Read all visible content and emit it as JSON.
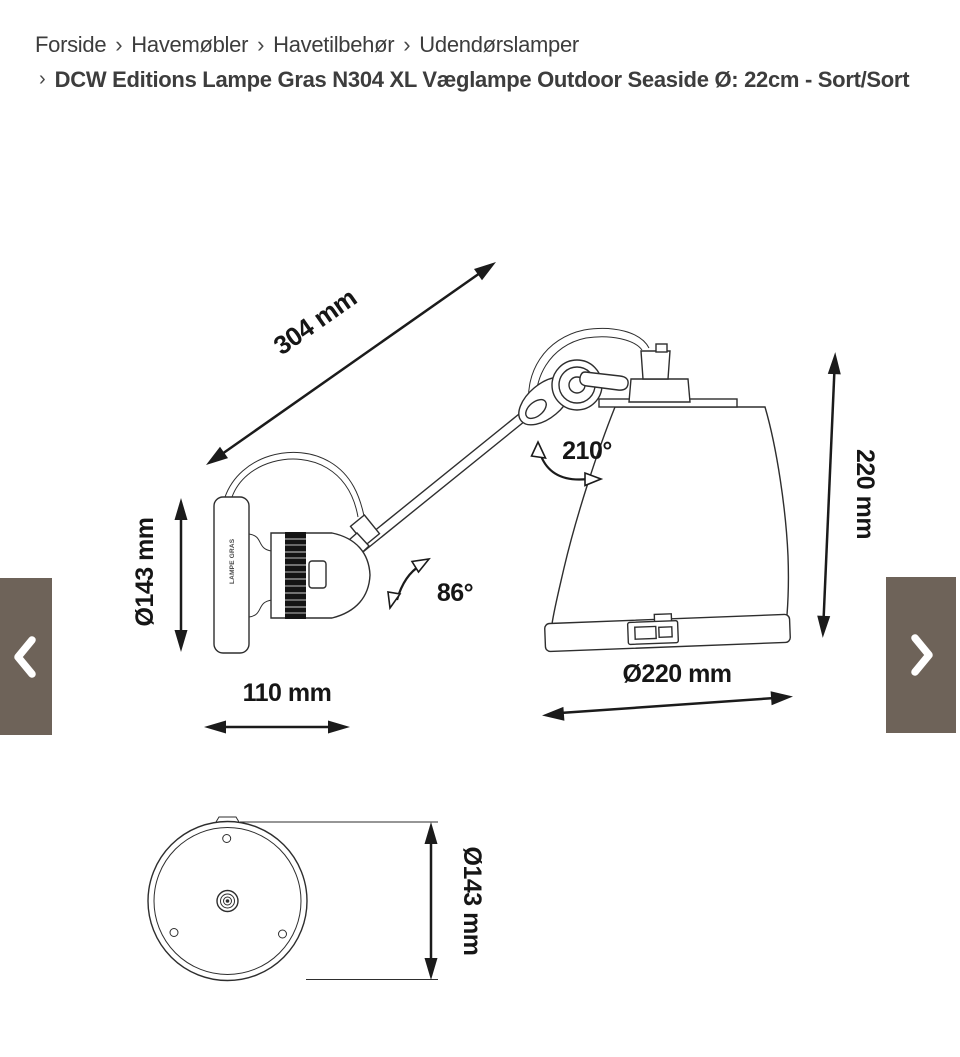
{
  "breadcrumb": {
    "separator": "›",
    "items": [
      {
        "label": "Forside"
      },
      {
        "label": "Havemøbler"
      },
      {
        "label": "Havetilbehør"
      },
      {
        "label": "Udendørslamper"
      }
    ],
    "current": "DCW Editions Lampe Gras N304 XL Væglampe Outdoor Seaside Ø: 22cm - Sort/Sort"
  },
  "product_image": {
    "plate_label": "LAMPE GRAS",
    "dimensions": {
      "arm_length": "304 mm",
      "head_rotation": "210°",
      "arm_rotation": "86°",
      "base_diameter": "Ø143 mm",
      "base_depth": "110 mm",
      "shade_height": "220 mm",
      "shade_diameter": "Ø220 mm",
      "bottom_view_diameter": "Ø143 mm"
    }
  },
  "carousel": {
    "prev_icon": "chevron-left",
    "next_icon": "chevron-right",
    "button_color": "#6e6359",
    "icon_color": "#ffffff"
  },
  "colors": {
    "background": "#ffffff",
    "breadcrumb_text": "#3d3d3d",
    "drawing_line": "#2e2e2e",
    "dimension_text": "#161616"
  }
}
